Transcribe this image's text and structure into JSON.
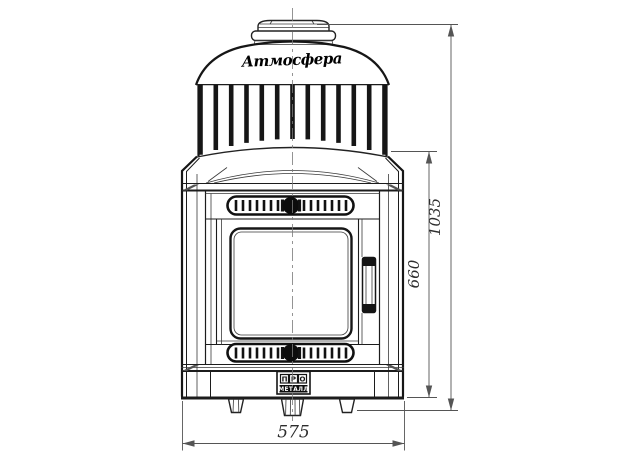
{
  "drawing": {
    "title": "Front-view technical drawing of a wood-burning sauna stove",
    "brand_script": "Атмосфера",
    "badge": {
      "letters": [
        "П",
        "Р",
        "О"
      ],
      "bottom_label": "МЕТАЛЛ"
    },
    "dimensions": {
      "overall_width_mm": "575",
      "body_height_mm": "660",
      "overall_height_mm": "1035"
    },
    "colors": {
      "line": "#1c1c1c",
      "dimension": "#555555",
      "dimension_text": "#2d2d2d",
      "background": "#ffffff"
    }
  }
}
